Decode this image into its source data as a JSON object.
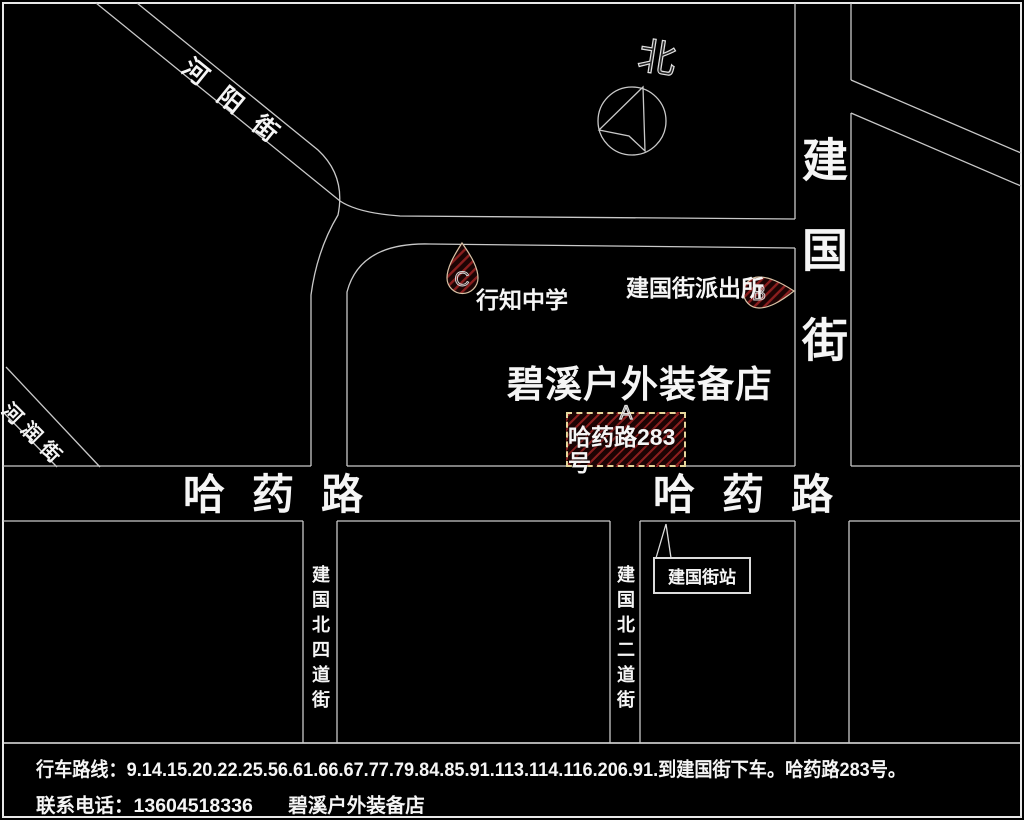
{
  "colors": {
    "background": "#000000",
    "road_line": "#c9c9c9",
    "frame": "#e8e8e8",
    "text": "#f5f5f5",
    "hatch_stripe": "#8a1e1e",
    "hatch_bg": "#1c0404",
    "marker_outline": "#d9c3a6",
    "address_box_border": "#e7d89c"
  },
  "compass": {
    "label": "北"
  },
  "streets": {
    "heyang": "河阳街",
    "herun": "河润街",
    "jianguo_vertical": "建国街",
    "hayao_west": "哈药路",
    "hayao_east": "哈药路",
    "jianguo_north_4th": "建国北四道街",
    "jianguo_north_2nd": "建国北二道街"
  },
  "pois": {
    "store_title": "碧溪户外装备店",
    "school": "行知中学",
    "police": "建国街派出所",
    "station": "建国街站"
  },
  "markers": {
    "a": {
      "letter": "A",
      "address": "哈药路283号"
    },
    "b": {
      "letter": "B"
    },
    "c": {
      "letter": "C"
    }
  },
  "footer": {
    "route": "行车路线：9.14.15.20.22.25.56.61.66.67.77.79.84.85.91.113.114.116.206.91.到建国街下车。哈药路283号。",
    "contact": "联系电话：13604518336",
    "store": "碧溪户外装备店"
  }
}
